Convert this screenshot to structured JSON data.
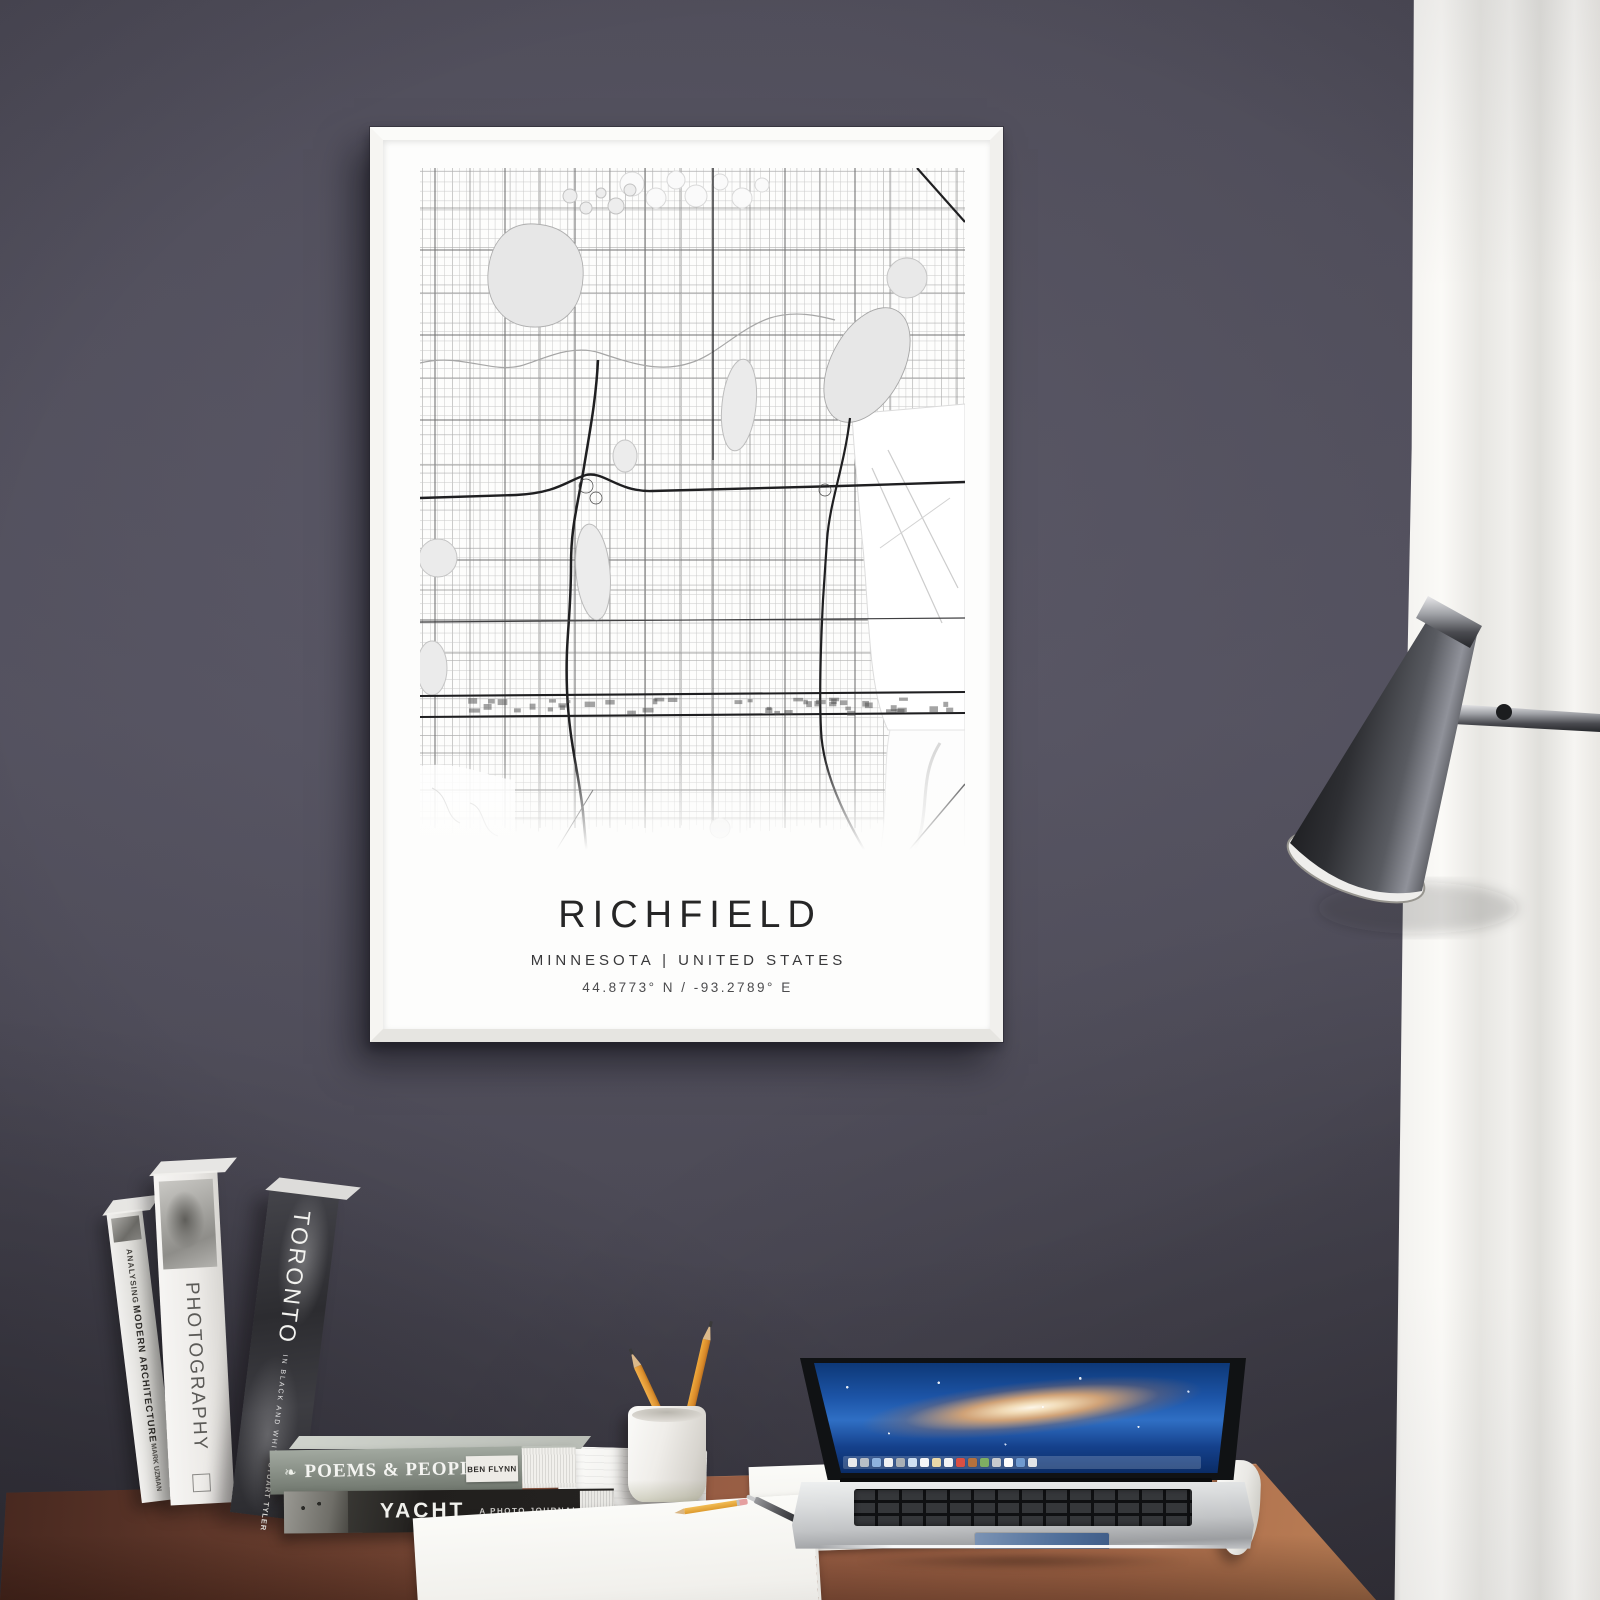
{
  "poster": {
    "title": "RICHFIELD",
    "subtitle": "MINNESOTA | UNITED STATES",
    "coordinates": "44.8773° N / -93.2789° E"
  },
  "books": {
    "standing": [
      {
        "title_line1": "ANALYSING",
        "title_line2": "MODERN ARCHITECTURE",
        "author": "MARK UZMAN"
      },
      {
        "title": "PHOTOGRAPHY"
      },
      {
        "title": "TORONTO",
        "subtitle": "IN BLACK AND WHITE",
        "author": "STUART TYLER"
      }
    ],
    "stacked": [
      {
        "title": "POEMS & PEOPLE",
        "author": "BEN FLYNN",
        "icon": "leaf-icon",
        "leaf_glyph": "❧"
      },
      {
        "title": "YACHT",
        "subtitle": "A PHOTO JOURNAL"
      }
    ]
  },
  "laptop": {
    "dock_colors": [
      "#e8eaec",
      "#b8bfc6",
      "#8fb3de",
      "#f1f2f3",
      "#a9b0b6",
      "#cfe0f2",
      "#f5f6f7",
      "#ead9a8",
      "#f2f3f4",
      "#d94f43",
      "#b5713d",
      "#7fae62",
      "#c8cbce",
      "#fdfdfd",
      "#6f9ad0",
      "#e2e4e6"
    ]
  },
  "colors": {
    "wall": "#4d4b57",
    "curtain": "#f2f1ef",
    "desk_wood": "#a2644a",
    "frame": "#f7f7f5",
    "poster_paper": "#fdfdfc",
    "map_lake": "#e7e7e7",
    "map_street": "#c7c7c7",
    "map_arterial": "#707070",
    "map_freeway": "#1f1f21",
    "poster_text": "#262626"
  }
}
